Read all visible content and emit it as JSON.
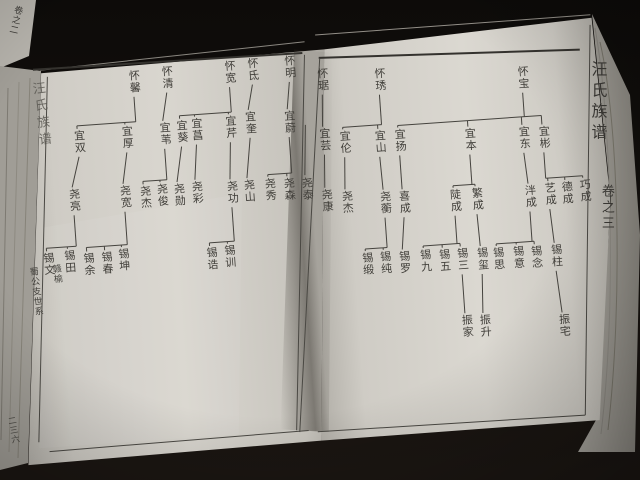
{
  "book": {
    "title": "汪氏族谱",
    "volume": "卷之三",
    "left_margin_title": "汪氏族谱",
    "section_label_place": "赣榆",
    "section_label_branch": "蜀公支世系",
    "page_number": "二三六",
    "spine_label": "卷之二"
  },
  "colors": {
    "ink": "#403e39",
    "paper": "#d8d5ce",
    "desk": "#12100d",
    "connector": "#45433e"
  },
  "chart_data": {
    "type": "table",
    "title": "汪氏族谱 卷之三 世系图",
    "generations": [
      "怀",
      "宜",
      "尧/成",
      "锡",
      "振"
    ],
    "lineages_left_page": [
      {
        "parent": "怀馨",
        "children": [
          "宜双",
          "宜厚"
        ]
      },
      {
        "parent": "怀清",
        "children": [
          "宜苇"
        ]
      },
      {
        "parent": "怀宽",
        "children": [
          "宜葵",
          "宜菖",
          "宜芹"
        ]
      },
      {
        "parent": "怀氐",
        "children": [
          "宜奎"
        ]
      },
      {
        "parent": "怀明",
        "children": [
          "宜蔚"
        ]
      },
      {
        "parent": "宜双",
        "children": [
          "尧亮"
        ]
      },
      {
        "parent": "宜厚",
        "children": [
          "尧宽"
        ]
      },
      {
        "parent": "宜苇",
        "children": [
          "尧杰",
          "尧俊"
        ]
      },
      {
        "parent": "宜葵",
        "children": [
          "尧勋"
        ]
      },
      {
        "parent": "宜菖",
        "children": [
          "尧彩"
        ]
      },
      {
        "parent": "宜芹",
        "children": [
          "尧功"
        ]
      },
      {
        "parent": "宜奎",
        "children": [
          "尧山"
        ]
      },
      {
        "parent": "宜蔚",
        "children": [
          "尧秀",
          "尧森"
        ]
      },
      {
        "parent": "",
        "children": [
          "尧泰"
        ]
      },
      {
        "parent": "尧亮",
        "children": [
          "锡文",
          "锡田"
        ]
      },
      {
        "parent": "尧宽",
        "children": [
          "锡余",
          "锡春",
          "锡坤"
        ]
      },
      {
        "parent": "尧功",
        "children": [
          "锡诰",
          "锡训"
        ]
      }
    ],
    "lineages_right_page": [
      {
        "parent": "怀琚",
        "children": [
          "宜芸"
        ]
      },
      {
        "parent": "怀琇",
        "children": [
          "宜伦",
          "宜山"
        ]
      },
      {
        "parent": "怀宝",
        "children": [
          "宜扬",
          "宜本",
          "宜东",
          "宜彬"
        ]
      },
      {
        "parent": "宜芸",
        "children": [
          "尧康"
        ]
      },
      {
        "parent": "宜伦",
        "children": [
          "尧杰"
        ]
      },
      {
        "parent": "宜山",
        "children": [
          "尧蘅"
        ]
      },
      {
        "parent": "宜扬",
        "children": [
          "喜成"
        ]
      },
      {
        "parent": "宜本",
        "children": [
          "陡成",
          "繁成"
        ]
      },
      {
        "parent": "宜东",
        "children": [
          "泮成"
        ]
      },
      {
        "parent": "宜彬",
        "children": [
          "艺成",
          "德成",
          "巧成"
        ]
      },
      {
        "parent": "尧蘅",
        "children": [
          "锡缎",
          "锡纯"
        ]
      },
      {
        "parent": "喜成",
        "children": [
          "锡罗"
        ]
      },
      {
        "parent": "陡成",
        "children": [
          "锡九",
          "锡五",
          "锡三"
        ]
      },
      {
        "parent": "繁成",
        "children": [
          "锡玺"
        ]
      },
      {
        "parent": "泮成",
        "children": [
          "锡思",
          "锡意",
          "锡念"
        ]
      },
      {
        "parent": "艺成",
        "children": [
          "锡柱"
        ]
      },
      {
        "parent": "锡三",
        "children": [
          "振家"
        ]
      },
      {
        "parent": "锡玺",
        "children": [
          "振升"
        ]
      },
      {
        "parent": "锡柱",
        "children": [
          "振宅"
        ]
      }
    ]
  },
  "tree": {
    "pages": [
      {
        "id": "left",
        "nodes": [
          {
            "id": "huai-xin",
            "n": "怀馨",
            "x": 129,
            "y": 49
          },
          {
            "id": "huai-qing",
            "n": "怀清",
            "x": 162,
            "y": 47
          },
          {
            "id": "huai-kuan",
            "n": "怀宽",
            "x": 225,
            "y": 46
          },
          {
            "id": "huai-di",
            "n": "怀氐",
            "x": 248,
            "y": 45
          },
          {
            "id": "huai-ming",
            "n": "怀明",
            "x": 285,
            "y": 45
          },
          {
            "id": "yi-shuang",
            "n": "宜双",
            "x": 70,
            "y": 105
          },
          {
            "id": "yi-hou",
            "n": "宜厚",
            "x": 118,
            "y": 104
          },
          {
            "id": "yi-wei1",
            "n": "宜苇",
            "x": 156,
            "y": 103
          },
          {
            "id": "yi-kui1",
            "n": "宜葵",
            "x": 173,
            "y": 102
          },
          {
            "id": "yi-chang",
            "n": "宜菖",
            "x": 188,
            "y": 101
          },
          {
            "id": "yi-qin",
            "n": "宜芹",
            "x": 222,
            "y": 101
          },
          {
            "id": "yi-kui2",
            "n": "宜奎",
            "x": 242,
            "y": 98
          },
          {
            "id": "yi-wei2",
            "n": "宜蔚",
            "x": 281,
            "y": 100
          },
          {
            "id": "yao-liang",
            "n": "尧亮",
            "x": 61,
            "y": 163
          },
          {
            "id": "yao-kuan",
            "n": "尧宽",
            "x": 112,
            "y": 163
          },
          {
            "id": "yao-jie-l",
            "n": "尧杰",
            "x": 132,
            "y": 165
          },
          {
            "id": "yao-jun",
            "n": "尧俊",
            "x": 149,
            "y": 164
          },
          {
            "id": "yao-xun",
            "n": "尧勋",
            "x": 166,
            "y": 165
          },
          {
            "id": "yao-cai",
            "n": "尧彩",
            "x": 184,
            "y": 164
          },
          {
            "id": "yao-gong",
            "n": "尧功",
            "x": 219,
            "y": 166
          },
          {
            "id": "yao-shan",
            "n": "尧山",
            "x": 236,
            "y": 166
          },
          {
            "id": "yao-xiu",
            "n": "尧秀",
            "x": 257,
            "y": 166
          },
          {
            "id": "yao-sen",
            "n": "尧森",
            "x": 276,
            "y": 167
          },
          {
            "id": "yao-tai",
            "n": "尧泰",
            "x": 294,
            "y": 168
          },
          {
            "id": "xi-wen",
            "n": "锡文",
            "x": 31,
            "y": 225
          },
          {
            "id": "xi-tian",
            "n": "锡田",
            "x": 52,
            "y": 224
          },
          {
            "id": "xi-yu",
            "n": "锡余",
            "x": 71,
            "y": 228
          },
          {
            "id": "xi-chun1",
            "n": "锡春",
            "x": 89,
            "y": 228
          },
          {
            "id": "xi-kun",
            "n": "锡坤",
            "x": 106,
            "y": 226
          },
          {
            "id": "xi-gao",
            "n": "锡诰",
            "x": 194,
            "y": 231
          },
          {
            "id": "xi-xun",
            "n": "锡训",
            "x": 212,
            "y": 230
          }
        ],
        "families": [
          {
            "parent": "huai-xin",
            "children": [
              "yi-shuang",
              "yi-hou"
            ]
          },
          {
            "parent": "huai-qing",
            "children": [
              "yi-wei1"
            ]
          },
          {
            "parent": "huai-kuan",
            "children": [
              "yi-kui1",
              "yi-chang",
              "yi-qin"
            ]
          },
          {
            "parent": "huai-di",
            "children": [
              "yi-kui2"
            ]
          },
          {
            "parent": "huai-ming",
            "children": [
              "yi-wei2"
            ]
          },
          {
            "parent": "yi-shuang",
            "children": [
              "yao-liang"
            ]
          },
          {
            "parent": "yi-hou",
            "children": [
              "yao-kuan"
            ]
          },
          {
            "parent": "yi-wei1",
            "children": [
              "yao-jie-l",
              "yao-jun"
            ]
          },
          {
            "parent": "yi-kui1",
            "children": [
              "yao-xun"
            ]
          },
          {
            "parent": "yi-chang",
            "children": [
              "yao-cai"
            ]
          },
          {
            "parent": "yi-qin",
            "children": [
              "yao-gong"
            ]
          },
          {
            "parent": "yi-kui2",
            "children": [
              "yao-shan"
            ]
          },
          {
            "parent": "yi-wei2",
            "children": [
              "yao-xiu",
              "yao-sen"
            ]
          },
          {
            "parent": null,
            "stub": true,
            "children": [
              "yao-tai"
            ]
          },
          {
            "parent": "yao-liang",
            "children": [
              "xi-wen",
              "xi-tian"
            ]
          },
          {
            "parent": "yao-kuan",
            "children": [
              "xi-yu",
              "xi-chun1",
              "xi-kun"
            ]
          },
          {
            "parent": "yao-gong",
            "children": [
              "xi-gao",
              "xi-xun"
            ]
          }
        ]
      },
      {
        "id": "right",
        "nodes": [
          {
            "id": "huai-ju",
            "n": "怀琚",
            "x": 317,
            "y": 60
          },
          {
            "id": "huai-xiu",
            "n": "怀琇",
            "x": 374,
            "y": 64
          },
          {
            "id": "huai-bao",
            "n": "怀宝",
            "x": 517,
            "y": 72
          },
          {
            "id": "yi-yun",
            "n": "宜芸",
            "x": 315,
            "y": 120
          },
          {
            "id": "yi-lun",
            "n": "宜伦",
            "x": 335,
            "y": 124
          },
          {
            "id": "yi-shan",
            "n": "宜山",
            "x": 370,
            "y": 126
          },
          {
            "id": "yi-yang",
            "n": "宜扬",
            "x": 390,
            "y": 126
          },
          {
            "id": "yi-ben",
            "n": "宜本",
            "x": 460,
            "y": 130
          },
          {
            "id": "yi-dong",
            "n": "宜东",
            "x": 514,
            "y": 132
          },
          {
            "id": "yi-bin",
            "n": "宜彬",
            "x": 534,
            "y": 133
          },
          {
            "id": "yao-kang",
            "n": "尧康",
            "x": 313,
            "y": 181
          },
          {
            "id": "yao-jie-r",
            "n": "尧杰",
            "x": 333,
            "y": 184
          },
          {
            "id": "yao-heng",
            "n": "尧蘅",
            "x": 371,
            "y": 187
          },
          {
            "id": "xicheng",
            "n": "喜成",
            "x": 390,
            "y": 188
          },
          {
            "id": "doucheng",
            "n": "陡成",
            "x": 441,
            "y": 190
          },
          {
            "id": "fancheng",
            "n": "繁成",
            "x": 463,
            "y": 190
          },
          {
            "id": "pancheng",
            "n": "泮成",
            "x": 516,
            "y": 191
          },
          {
            "id": "yicheng",
            "n": "艺成",
            "x": 536,
            "y": 190
          },
          {
            "id": "decheng",
            "n": "德成",
            "x": 553,
            "y": 190
          },
          {
            "id": "qiaocheng",
            "n": "巧成",
            "x": 571,
            "y": 189
          },
          {
            "id": "xi-duan",
            "n": "锡缎",
            "x": 349,
            "y": 247
          },
          {
            "id": "xi-chun2",
            "n": "锡纯",
            "x": 367,
            "y": 247
          },
          {
            "id": "xi-luo",
            "n": "锡罗",
            "x": 386,
            "y": 248
          },
          {
            "id": "xi-jiu",
            "n": "锡九",
            "x": 407,
            "y": 248
          },
          {
            "id": "xi-wu",
            "n": "锡五",
            "x": 426,
            "y": 249
          },
          {
            "id": "xi-san",
            "n": "锡三",
            "x": 444,
            "y": 249
          },
          {
            "id": "xi-xi",
            "n": "锡玺",
            "x": 464,
            "y": 250
          },
          {
            "id": "xi-si",
            "n": "锡思",
            "x": 480,
            "y": 251
          },
          {
            "id": "xi-yi",
            "n": "锡意",
            "x": 500,
            "y": 251
          },
          {
            "id": "xi-nian",
            "n": "锡念",
            "x": 518,
            "y": 252
          },
          {
            "id": "xi-zhu",
            "n": "锡柱",
            "x": 538,
            "y": 252
          },
          {
            "id": "zhen-jia",
            "n": "振家",
            "x": 444,
            "y": 316
          },
          {
            "id": "zhen-sheng",
            "n": "振升",
            "x": 462,
            "y": 317
          },
          {
            "id": "zhen-zhai",
            "n": "振宅",
            "x": 541,
            "y": 322
          }
        ],
        "families": [
          {
            "parent": "huai-ju",
            "children": [
              "yi-yun"
            ]
          },
          {
            "parent": "huai-xiu",
            "children": [
              "yi-lun",
              "yi-shan"
            ]
          },
          {
            "parent": "huai-bao",
            "children": [
              "yi-yang",
              "yi-ben",
              "yi-dong",
              "yi-bin"
            ]
          },
          {
            "parent": "yi-yun",
            "children": [
              "yao-kang"
            ]
          },
          {
            "parent": "yi-lun",
            "children": [
              "yao-jie-r"
            ]
          },
          {
            "parent": "yi-shan",
            "children": [
              "yao-heng"
            ]
          },
          {
            "parent": "yi-yang",
            "children": [
              "xicheng"
            ]
          },
          {
            "parent": "yi-ben",
            "children": [
              "doucheng",
              "fancheng"
            ]
          },
          {
            "parent": "yi-dong",
            "children": [
              "pancheng"
            ]
          },
          {
            "parent": "yi-bin",
            "children": [
              "yicheng",
              "decheng",
              "qiaocheng"
            ]
          },
          {
            "parent": "yao-heng",
            "children": [
              "xi-duan",
              "xi-chun2"
            ]
          },
          {
            "parent": "xicheng",
            "children": [
              "xi-luo"
            ]
          },
          {
            "parent": "doucheng",
            "children": [
              "xi-jiu",
              "xi-wu",
              "xi-san"
            ]
          },
          {
            "parent": "fancheng",
            "children": [
              "xi-xi"
            ]
          },
          {
            "parent": "pancheng",
            "children": [
              "xi-si",
              "xi-yi",
              "xi-nian"
            ]
          },
          {
            "parent": "yicheng",
            "children": [
              "xi-zhu"
            ]
          },
          {
            "parent": "xi-san",
            "children": [
              "zhen-jia"
            ]
          },
          {
            "parent": "xi-xi",
            "children": [
              "zhen-sheng"
            ]
          },
          {
            "parent": "xi-zhu",
            "children": [
              "zhen-zhai"
            ]
          }
        ]
      }
    ]
  }
}
